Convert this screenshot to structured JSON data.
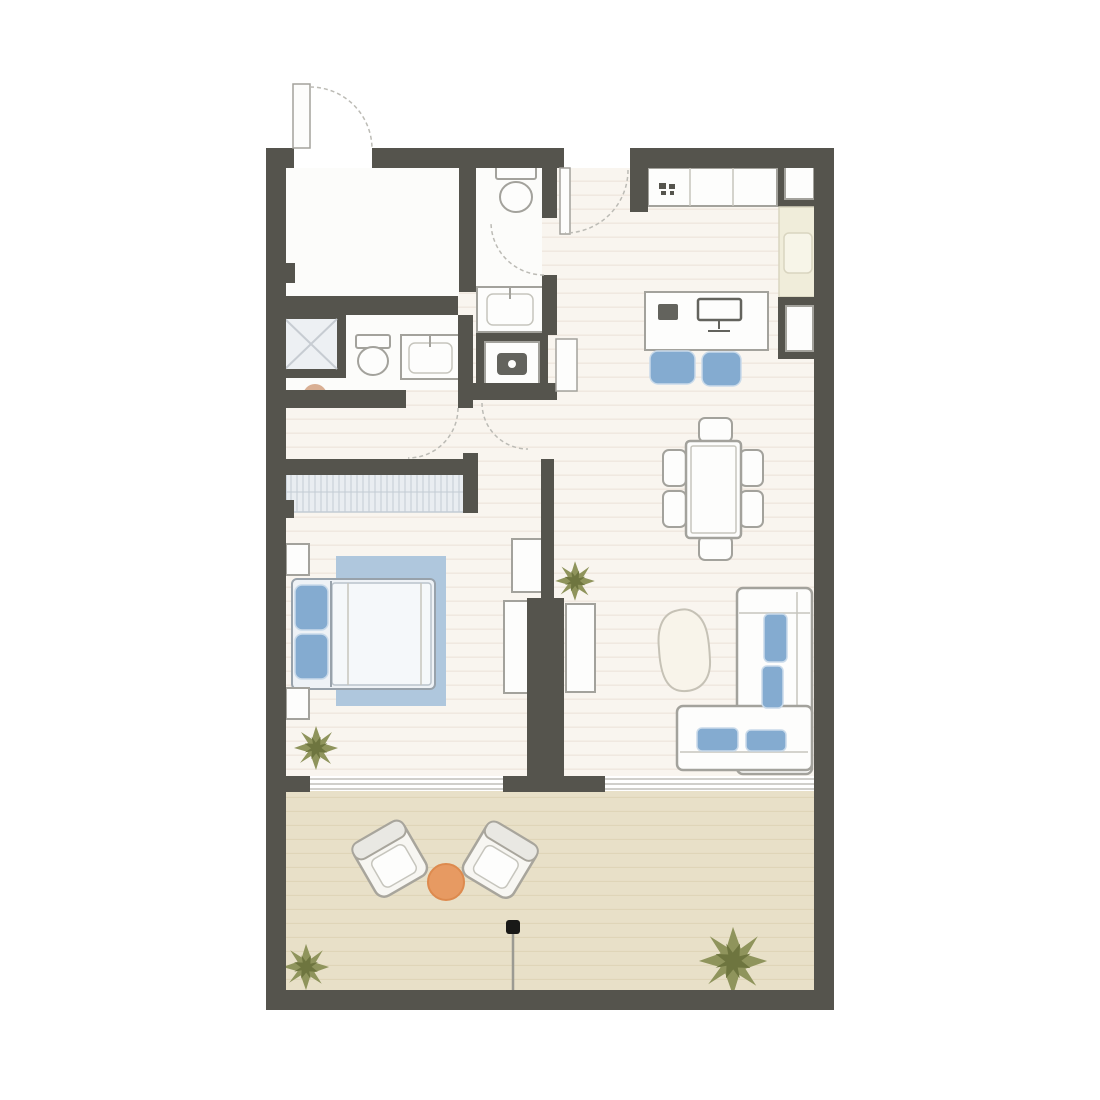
{
  "plan": {
    "kind": "apartment-floor-plan",
    "rooms": [
      "entry-foyer",
      "guest-wc",
      "bathroom",
      "laundry-closet",
      "hallway",
      "bedroom",
      "kitchen",
      "dining-area",
      "study-nook",
      "living-area",
      "terrace"
    ],
    "furniture_icons": [
      "entry-door-icon",
      "interior-door-icon",
      "shower-icon",
      "toilet-icon",
      "sink-vanity-icon",
      "washer-icon",
      "stool-icon",
      "kitchen-counter-icon",
      "stove-knobs-icon",
      "service-shaft-icon",
      "kitchen-sink-icon",
      "desk-icon",
      "monitor-icon",
      "laptop-icon",
      "desk-chair-icon",
      "dining-table-icon",
      "dining-chair-icon",
      "sofa-icon",
      "sofa-cushion-icon",
      "coffee-table-icon",
      "tv-console-icon",
      "cabinet-icon",
      "wardrobe-icon",
      "double-bed-icon",
      "pillow-icon",
      "rug-icon",
      "nightstand-icon",
      "plant-icon",
      "lounge-chair-icon",
      "side-table-icon",
      "parasol-base-icon",
      "window-icon"
    ]
  },
  "colors": {
    "wall": "#55544d",
    "floor": "#f9f5ef",
    "floor-line": "#f0e8df",
    "room-white": "#fcfcfa",
    "terrace": "#e8e0c8",
    "terrace-line": "#ded4b6",
    "outline": "#a3a29c",
    "outline-light": "#c6c5bd",
    "fixture-white": "#fdfdfc",
    "window-line": "#b3b2ac",
    "door-arc": "#bcbbb5",
    "blue": "#84abd0",
    "blue-light": "#c9daea",
    "rug-blue": "#afc7dd",
    "bed-white": "#eef2f6",
    "bed-line": "#98a2ab",
    "duvet-white": "#f5f8fa",
    "duvet-line": "#bac3cb",
    "wardrobe-base": "#e9edf1",
    "wardrobe-line": "#c3ccd4",
    "shower-fill": "#edf0f3",
    "shower-line": "#c7ccd2",
    "counter-cream": "#f0edda",
    "counter-cream-sink": "#f7f5e8",
    "counter-cream-line": "#d9d5c0",
    "appliance-dark": "#63635d",
    "orange": "#e79a62",
    "orange-dark": "#dd8a4e",
    "olive": "#8f945c",
    "olive-dark": "#6e753f",
    "tan": "#d9af93",
    "tan-dark": "#d09c7b",
    "lounge-white": "#f7f6f2",
    "lounge-back": "#e9e8e3",
    "lounge-outline": "#a8a59c",
    "coffee-cream": "#f8f4ea",
    "coffee-line": "#c6c2b6",
    "parasol-black": "#191917",
    "pole-gray": "#9b9a92"
  }
}
